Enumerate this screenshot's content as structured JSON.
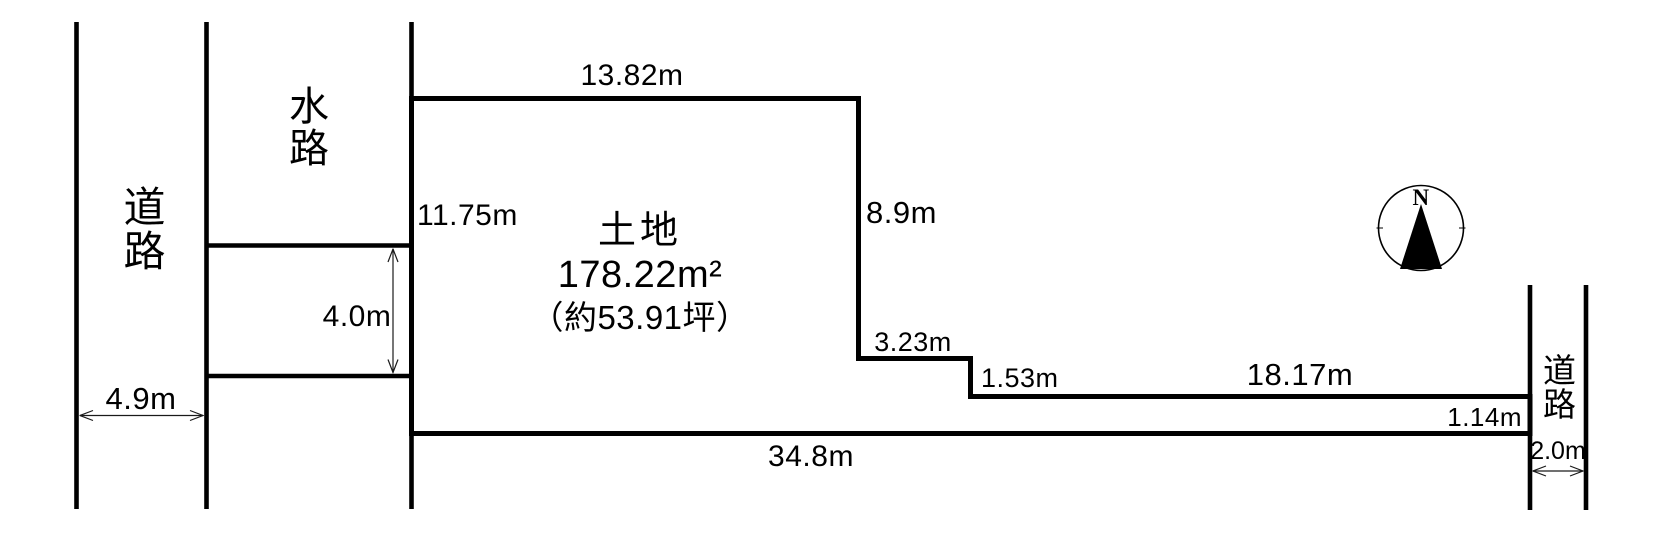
{
  "diagram": {
    "type": "land-survey-plot",
    "background_color": "#ffffff",
    "line_color": "#000000"
  },
  "land": {
    "label": "土地",
    "area": "178.22m²",
    "area_tsubo": "（約53.91坪）"
  },
  "roads": {
    "left": {
      "label": "道路",
      "width": "4.9m"
    },
    "right": {
      "label": "道路",
      "width": "2.0m"
    }
  },
  "waterway": {
    "label": "水路",
    "strip_width": "4.0m"
  },
  "dimensions": {
    "north_edge": "13.82m",
    "west_edge": "11.75m",
    "east_edge_upper": "8.9m",
    "step_horizontal": "3.23m",
    "step_vertical": "1.53m",
    "southeast_edge": "18.17m",
    "east_road_frontage": "1.14m",
    "south_edge": "34.8m"
  },
  "compass": {
    "north": "N"
  }
}
